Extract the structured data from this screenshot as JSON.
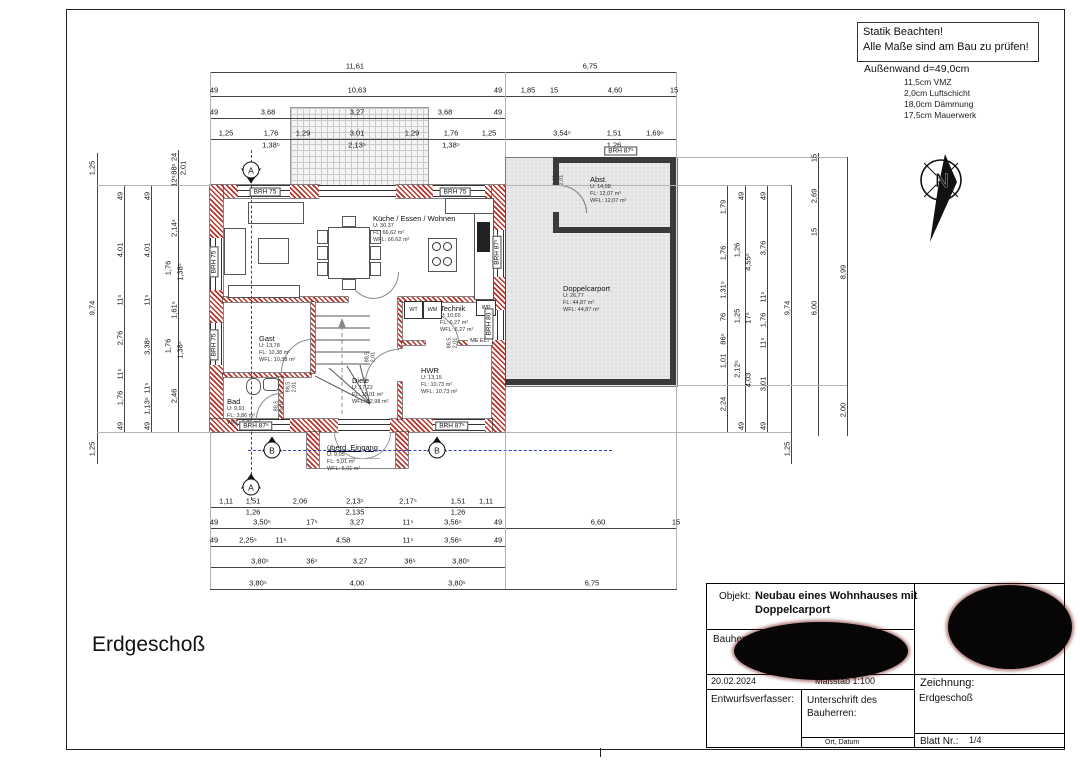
{
  "notes": {
    "statik_line1": "Statik Beachten!",
    "statik_line2": "Alle Maße sind am Bau zu prüfen!",
    "aussenwand_title": "Außenwand d=49,0cm",
    "aussenwand_items": [
      "11,5cm VMZ",
      "2,0cm Luftschicht",
      "18,0cm Dämmung",
      "17,5cm Mauerwerk"
    ]
  },
  "north_letter": "N",
  "floor_label": "Erdgeschoß",
  "plan": {
    "rooms": [
      {
        "name": "Küche / Essen / Wohnen",
        "lines": [
          "U: 30,37",
          "FL: 66,62 m²",
          "WFL: 66,62 m²"
        ],
        "x": 373,
        "y": 214,
        "u": false
      },
      {
        "name": "Gast",
        "lines": [
          "U: 13,78",
          "FL: 10,38 m²",
          "WFL: 10,38 m²"
        ],
        "x": 259,
        "y": 334,
        "u": false
      },
      {
        "name": "Bad",
        "lines": [
          "U: 9,91",
          "FL: 3,86 m²",
          "WFL: 3,86 m²"
        ],
        "x": 227,
        "y": 397,
        "u": false
      },
      {
        "name": "Diele",
        "lines": [
          "U: 17,22",
          "FL: 15,01 m²",
          "WFL: 12,98 m²"
        ],
        "x": 352,
        "y": 376,
        "u": false
      },
      {
        "name": "HWR",
        "lines": [
          "U: 13,15",
          "FL: 10,73 m²",
          "WFL: 10,73 m²"
        ],
        "x": 421,
        "y": 366,
        "u": false
      },
      {
        "name": "Technik",
        "lines": [
          "U: 10,65",
          "FL: 6,27 m²",
          "WFL: 6,27 m²"
        ],
        "x": 440,
        "y": 304,
        "u": false
      },
      {
        "name": "Abst.",
        "lines": [
          "U: 14,08",
          "FL: 12,07 m²",
          "WFL: 12,07 m²"
        ],
        "x": 590,
        "y": 175,
        "u": false
      },
      {
        "name": "Doppelcarport",
        "lines": [
          "U: 26,77",
          "FL: 44,87 m²",
          "WFL: 44,87 m²"
        ],
        "x": 563,
        "y": 284,
        "u": false
      },
      {
        "name": "überd. Eingang",
        "lines": [
          "U: 9,05",
          "FL: 5,01 m²",
          "WFL: 5,01 m²"
        ],
        "x": 327,
        "y": 443,
        "u": true
      }
    ],
    "brh_labels": [
      [
        "BRH 75",
        265,
        192,
        0
      ],
      [
        "BRH 75",
        455,
        192,
        0
      ],
      [
        "BRH 75",
        214,
        262,
        1
      ],
      [
        "BRH 75",
        214,
        345,
        1
      ],
      [
        "BRH 87⁵",
        497,
        252,
        1
      ],
      [
        "BRH 80",
        489,
        324,
        1
      ],
      [
        "BRH 87⁵",
        256,
        426,
        0
      ],
      [
        "BRH 87⁵",
        452,
        426,
        0
      ],
      [
        "BRH 87⁵",
        621,
        151,
        0
      ]
    ],
    "fixtures": [
      {
        "t": "WT",
        "x": 404,
        "y": 301,
        "w": 17,
        "h": 16,
        "box": true
      },
      {
        "t": "WM",
        "x": 423,
        "y": 301,
        "w": 17,
        "h": 16,
        "box": true
      },
      {
        "t": "WP",
        "x": 476,
        "y": 300,
        "w": 18,
        "h": 14,
        "box": true
      },
      {
        "t": "ME ELT",
        "x": 468,
        "y": 336,
        "w": 24,
        "h": 9,
        "box": false
      }
    ],
    "door_labels": [
      {
        "l": [
          "88,5",
          "2,01"
        ],
        "x": 292,
        "y": 387
      },
      {
        "l": [
          "88,5",
          "2,01"
        ],
        "x": 280,
        "y": 406
      },
      {
        "l": [
          "88,5",
          "2,01"
        ],
        "x": 371,
        "y": 357
      },
      {
        "l": [
          "88,5",
          "2,01"
        ],
        "x": 453,
        "y": 343
      },
      {
        "l": [
          "1,01",
          "2,01"
        ],
        "x": 559,
        "y": 180
      }
    ],
    "section_markers": [
      {
        "t": "A",
        "x": 251,
        "y": 170,
        "d": "down"
      },
      {
        "t": "A",
        "x": 251,
        "y": 487,
        "d": "up"
      },
      {
        "t": "B",
        "x": 272,
        "y": 450,
        "d": "up"
      },
      {
        "t": "B",
        "x": 437,
        "y": 450,
        "d": "up"
      }
    ],
    "dims": [
      [
        "11,61",
        355,
        66,
        0
      ],
      [
        "6,75",
        590,
        66,
        0
      ],
      [
        "49",
        214,
        90,
        0
      ],
      [
        "10,63",
        357,
        90,
        0
      ],
      [
        "49",
        498,
        90,
        0
      ],
      [
        "1,85",
        528,
        90,
        0
      ],
      [
        "15",
        554,
        90,
        0
      ],
      [
        "4,60",
        615,
        90,
        0
      ],
      [
        "15",
        674,
        90,
        0
      ],
      [
        "49",
        214,
        112,
        0
      ],
      [
        "3,68",
        268,
        112,
        0
      ],
      [
        "3,27",
        357,
        112,
        0
      ],
      [
        "3,68",
        445,
        112,
        0
      ],
      [
        "49",
        498,
        112,
        0
      ],
      [
        "1,25",
        226,
        133,
        0
      ],
      [
        "1,76",
        271,
        133,
        0
      ],
      [
        "1,29",
        303,
        133,
        0
      ],
      [
        "3,01",
        357,
        133,
        0
      ],
      [
        "1,29",
        412,
        133,
        0
      ],
      [
        "1,76",
        451,
        133,
        0
      ],
      [
        "1,25",
        489,
        133,
        0
      ],
      [
        "3,54⁵",
        562,
        133,
        0
      ],
      [
        "1,51",
        614,
        133,
        0
      ],
      [
        "1,69⁵",
        655,
        133,
        0
      ],
      [
        "1,38⁵",
        271,
        145,
        0
      ],
      [
        "2,13⁵",
        357,
        145,
        0
      ],
      [
        "1,38⁵",
        451,
        145,
        0
      ],
      [
        "1,26",
        614,
        145,
        0
      ],
      [
        "1,25",
        92,
        168,
        1
      ],
      [
        "9,74",
        92,
        308,
        1
      ],
      [
        "1,25",
        92,
        449,
        1
      ],
      [
        "49",
        120,
        196,
        1
      ],
      [
        "4,01",
        120,
        250,
        1
      ],
      [
        "11⁵",
        120,
        300,
        1
      ],
      [
        "2,76",
        120,
        338,
        1
      ],
      [
        "11⁵",
        120,
        374,
        1
      ],
      [
        "1,76",
        120,
        398,
        1
      ],
      [
        "49",
        120,
        426,
        1
      ],
      [
        "49",
        147,
        196,
        1
      ],
      [
        "4,01",
        147,
        250,
        1
      ],
      [
        "11⁵",
        147,
        300,
        1
      ],
      [
        "3,38⁵",
        147,
        346,
        1
      ],
      [
        "11⁵",
        147,
        388,
        1
      ],
      [
        "1,13⁵",
        147,
        406,
        1
      ],
      [
        "49",
        147,
        426,
        1
      ],
      [
        "24",
        174,
        157,
        1
      ],
      [
        "88⁵",
        174,
        169,
        1
      ],
      [
        "12⁵",
        174,
        181,
        1
      ],
      [
        "2,01",
        183,
        168,
        1
      ],
      [
        "2,14⁵",
        174,
        228,
        1
      ],
      [
        "1,76",
        168,
        268,
        1
      ],
      [
        "1,38⁵",
        180,
        272,
        1
      ],
      [
        "1,61⁵",
        174,
        310,
        1
      ],
      [
        "1,76",
        168,
        346,
        1
      ],
      [
        "1,38⁵",
        180,
        350,
        1
      ],
      [
        "2,46",
        174,
        396,
        1
      ],
      [
        "1,79",
        723,
        207,
        1
      ],
      [
        "1,76",
        723,
        253,
        1
      ],
      [
        "1,31⁵",
        723,
        290,
        1
      ],
      [
        "76",
        723,
        317,
        1
      ],
      [
        "86⁵",
        723,
        339,
        1
      ],
      [
        "1,01",
        723,
        361,
        1
      ],
      [
        "2,24",
        723,
        404,
        1
      ],
      [
        "49",
        741,
        196,
        1
      ],
      [
        "1,26",
        737,
        250,
        1
      ],
      [
        "4,55⁵",
        748,
        262,
        1
      ],
      [
        "1,25",
        737,
        316,
        1
      ],
      [
        "17⁵",
        748,
        318,
        1
      ],
      [
        "2,12⁵",
        737,
        369,
        1
      ],
      [
        "4,03",
        748,
        380,
        1
      ],
      [
        "49",
        741,
        426,
        1
      ],
      [
        "49",
        763,
        196,
        1
      ],
      [
        "3,76",
        763,
        248,
        1
      ],
      [
        "11⁵",
        763,
        297,
        1
      ],
      [
        "1,76",
        763,
        320,
        1
      ],
      [
        "11⁵",
        763,
        343,
        1
      ],
      [
        "3,01",
        763,
        384,
        1
      ],
      [
        "49",
        763,
        426,
        1
      ],
      [
        "9,74",
        787,
        308,
        1
      ],
      [
        "1,25",
        787,
        449,
        1
      ],
      [
        "15",
        814,
        158,
        1
      ],
      [
        "2,69",
        814,
        196,
        1
      ],
      [
        "15",
        814,
        232,
        1
      ],
      [
        "6,00",
        814,
        308,
        1
      ],
      [
        "8,99",
        843,
        272,
        1
      ],
      [
        "2,00",
        843,
        410,
        1
      ],
      [
        "1,11",
        226,
        501,
        0
      ],
      [
        "1,51",
        253,
        501,
        0
      ],
      [
        "2,06",
        300,
        501,
        0
      ],
      [
        "2,13⁵",
        355,
        501,
        0
      ],
      [
        "2,17⁵",
        408,
        501,
        0
      ],
      [
        "1,51",
        458,
        501,
        0
      ],
      [
        "1,11",
        486,
        501,
        0
      ],
      [
        "1,26",
        253,
        512,
        0
      ],
      [
        "2,135",
        355,
        512,
        0
      ],
      [
        "1,26",
        458,
        512,
        0
      ],
      [
        "49",
        214,
        522,
        0
      ],
      [
        "3,50⁵",
        262,
        522,
        0
      ],
      [
        "17⁵",
        312,
        522,
        0
      ],
      [
        "3,27",
        357,
        522,
        0
      ],
      [
        "11⁵",
        408,
        522,
        0
      ],
      [
        "3,56⁵",
        453,
        522,
        0
      ],
      [
        "49",
        498,
        522,
        0
      ],
      [
        "6,60",
        598,
        522,
        0
      ],
      [
        "15",
        676,
        522,
        0
      ],
      [
        "49",
        214,
        540,
        0
      ],
      [
        "2,25⁵",
        248,
        540,
        0
      ],
      [
        "11⁵",
        281,
        540,
        0
      ],
      [
        "4,58",
        343,
        540,
        0
      ],
      [
        "11⁵",
        408,
        540,
        0
      ],
      [
        "3,56⁵",
        453,
        540,
        0
      ],
      [
        "49",
        498,
        540,
        0
      ],
      [
        "3,80⁵",
        260,
        561,
        0
      ],
      [
        "36⁵",
        312,
        561,
        0
      ],
      [
        "3,27",
        360,
        561,
        0
      ],
      [
        "36⁵",
        410,
        561,
        0
      ],
      [
        "3,80⁵",
        461,
        561,
        0
      ],
      [
        "3,80⁵",
        258,
        583,
        0
      ],
      [
        "4,00",
        357,
        583,
        0
      ],
      [
        "3,80⁵",
        457,
        583,
        0
      ],
      [
        "6,75",
        592,
        583,
        0
      ]
    ]
  },
  "title_block": {
    "objekt_label": "Objekt:",
    "objekt_value": "Neubau eines Wohnhauses mit Doppelcarport",
    "bauherr_label": "Bauherr:",
    "date": "20.02.2024",
    "massstab": "Maßstab 1:100",
    "entwurf": "Entwurfsverfasser:",
    "unterschrift": "Unterschrift des Bauherren:",
    "ort_datum": "Ort, Datum",
    "zeichnung_label": "Zeichnung:",
    "zeichnung_value": "Erdgeschoß",
    "blatt_label": "Blatt Nr.:",
    "blatt_value": "1/4"
  }
}
